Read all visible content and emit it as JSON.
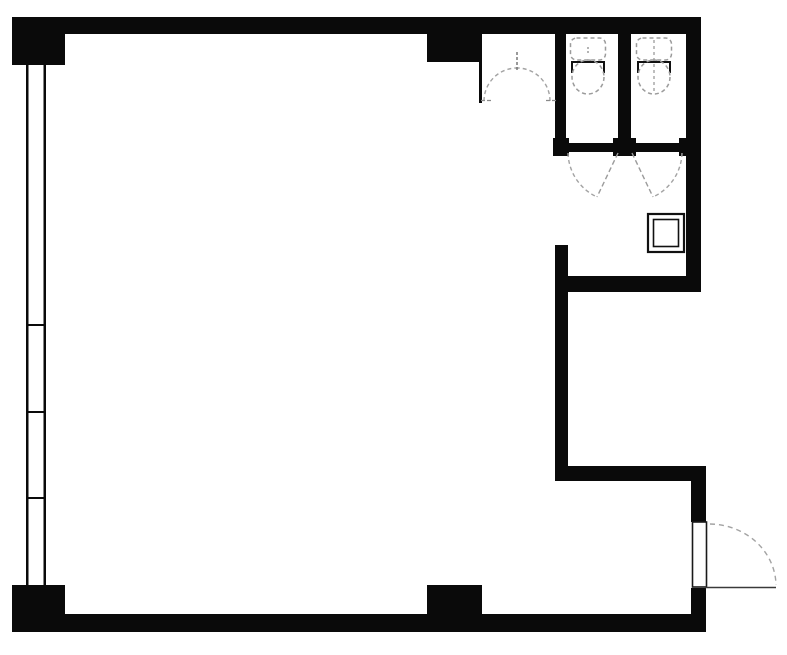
{
  "canvas": {
    "width": 787,
    "height": 655,
    "background": "#ffffff"
  },
  "colors": {
    "wall": "#0a0a0a",
    "thin_line": "#1a1a1a",
    "fixture_dash": "#9b9b9b",
    "door_arc": "#a3a3a3",
    "door_leaf": "#3a3a3a",
    "fixture_solid": "#111111",
    "floor": "#ffffff"
  },
  "floor_plan": {
    "description": "single-room floor plan with two toilet stalls top-right, window wall left, entry door bottom-right",
    "elements": [
      {
        "name": "top-wall",
        "kind": "rect",
        "x": 12,
        "y": 17,
        "w": 688,
        "h": 17
      },
      {
        "name": "top-left-corner-block",
        "kind": "rect",
        "x": 12,
        "y": 17,
        "w": 53,
        "h": 48
      },
      {
        "name": "bottom-left-corner-block",
        "kind": "rect",
        "x": 12,
        "y": 585,
        "w": 53,
        "h": 47
      },
      {
        "name": "bottom-wall",
        "kind": "rect",
        "x": 12,
        "y": 614,
        "w": 692,
        "h": 18
      },
      {
        "name": "top-center-pier",
        "kind": "rect",
        "x": 427,
        "y": 34,
        "w": 53,
        "h": 28
      },
      {
        "name": "bottom-center-pier",
        "kind": "rect",
        "x": 427,
        "y": 585,
        "w": 55,
        "h": 29
      },
      {
        "name": "right-wall-upper",
        "kind": "rect",
        "x": 686,
        "y": 17,
        "w": 15,
        "h": 275
      },
      {
        "name": "stall-left-wall",
        "kind": "rect",
        "x": 555,
        "y": 17,
        "w": 11,
        "h": 126
      },
      {
        "name": "stall-divider-wall",
        "kind": "rect",
        "x": 618,
        "y": 33,
        "w": 13,
        "h": 110
      },
      {
        "name": "stall-front-wall",
        "kind": "rect",
        "x": 555,
        "y": 143,
        "w": 146,
        "h": 9
      },
      {
        "name": "hinge-post-left",
        "kind": "rect",
        "x": 553,
        "y": 138,
        "w": 16,
        "h": 18
      },
      {
        "name": "hinge-post-center",
        "kind": "rect",
        "x": 613,
        "y": 138,
        "w": 23,
        "h": 18
      },
      {
        "name": "hinge-post-right",
        "kind": "rect",
        "x": 679,
        "y": 138,
        "w": 21,
        "h": 18
      },
      {
        "name": "anteroom-south-wall",
        "kind": "rect",
        "x": 555,
        "y": 276,
        "w": 146,
        "h": 16
      },
      {
        "name": "mid-right-wall",
        "kind": "rect",
        "x": 555,
        "y": 245,
        "w": 13,
        "h": 235
      },
      {
        "name": "lower-step-wall",
        "kind": "rect",
        "x": 555,
        "y": 466,
        "w": 151,
        "h": 15
      },
      {
        "name": "entry-wall-upper",
        "kind": "rect",
        "x": 691,
        "y": 466,
        "w": 15,
        "h": 56
      },
      {
        "name": "entry-wall-lower",
        "kind": "rect",
        "x": 691,
        "y": 588,
        "w": 15,
        "h": 44
      },
      {
        "name": "vestibule-partition-wall",
        "kind": "rect",
        "x": 479,
        "y": 34,
        "w": 3,
        "h": 69
      },
      {
        "name": "window-outer-line",
        "kind": "rect",
        "x": 26,
        "y": 65,
        "w": 2.5,
        "h": 520
      },
      {
        "name": "window-inner-line",
        "kind": "rect",
        "x": 43.5,
        "y": 65,
        "w": 2.5,
        "h": 520
      },
      {
        "name": "window-mullion-tick-1",
        "kind": "rect",
        "x": 28,
        "y": 324,
        "w": 16,
        "h": 2
      },
      {
        "name": "window-mullion-tick-2",
        "kind": "rect",
        "x": 28,
        "y": 411,
        "w": 16,
        "h": 2
      },
      {
        "name": "window-mullion-tick-3",
        "kind": "rect",
        "x": 28,
        "y": 497,
        "w": 16,
        "h": 2
      },
      {
        "name": "entrance-door-frame",
        "kind": "orect",
        "x": 692.5,
        "y": 522,
        "w": 14,
        "h": 65,
        "stroke": "#1a1a1a",
        "sw": 1.6,
        "fill": "#ffffff"
      },
      {
        "name": "entrance-door-leaf",
        "kind": "line",
        "x1": 705,
        "y1": 587.5,
        "x2": 776,
        "y2": 587.5,
        "stroke": "#3a3a3a",
        "sw": 1.6
      },
      {
        "name": "entrance-door-swing-arc",
        "kind": "path",
        "d": "M 710,524 A 67,62 0 0 1 776,585",
        "stroke": "#a3a3a3",
        "sw": 1.4,
        "dash": "5,4"
      },
      {
        "name": "vestibule-door-arc-left",
        "kind": "path",
        "d": "M 484,101 A 33,33 0 0 1 517,68",
        "stroke": "#a3a3a3",
        "sw": 1.4,
        "dash": "4,3"
      },
      {
        "name": "vestibule-door-arc-right",
        "kind": "path",
        "d": "M 550,101 A 33,33 0 0 0 517,68",
        "stroke": "#a3a3a3",
        "sw": 1.4,
        "dash": "4,3"
      },
      {
        "name": "vestibule-door-apex-tick",
        "kind": "line",
        "x1": 517,
        "y1": 52,
        "x2": 517,
        "y2": 70,
        "stroke": "#6f6f6f",
        "sw": 1.4,
        "dash": "3,2"
      },
      {
        "name": "vestibule-door-foot-tick-left",
        "kind": "line",
        "x1": 481,
        "y1": 100.5,
        "x2": 492,
        "y2": 100.5,
        "stroke": "#8a8a8a",
        "sw": 1.3,
        "dash": "4,2"
      },
      {
        "name": "vestibule-door-foot-tick-right",
        "kind": "line",
        "x1": 546,
        "y1": 100.5,
        "x2": 557,
        "y2": 100.5,
        "stroke": "#8a8a8a",
        "sw": 1.3,
        "dash": "4,2"
      },
      {
        "name": "stall-door-left-swing-arc",
        "kind": "path",
        "d": "M 568,153 A 50,50 0 0 0 597,197",
        "stroke": "#a3a3a3",
        "sw": 1.4,
        "dash": "4,3"
      },
      {
        "name": "stall-door-left-leaf",
        "kind": "line",
        "x1": 618,
        "y1": 153,
        "x2": 597,
        "y2": 197,
        "stroke": "#9b9b9b",
        "sw": 1.4,
        "dash": "5,3"
      },
      {
        "name": "stall-door-right-swing-arc",
        "kind": "path",
        "d": "M 682,153 A 50,50 0 0 1 653,197",
        "stroke": "#a3a3a3",
        "sw": 1.4,
        "dash": "4,3"
      },
      {
        "name": "stall-door-right-leaf",
        "kind": "line",
        "x1": 632,
        "y1": 153,
        "x2": 653,
        "y2": 197,
        "stroke": "#9b9b9b",
        "sw": 1.4,
        "dash": "5,3"
      },
      {
        "name": "toilet-1-tank",
        "kind": "orect",
        "x": 570.5,
        "y": 38,
        "w": 35,
        "h": 22,
        "rx": 6,
        "stroke": "#9b9b9b",
        "sw": 1.5,
        "fill": "none",
        "dash": "4,3"
      },
      {
        "name": "toilet-1-seat-bar",
        "kind": "path",
        "d": "M 572,73 L 572,62 L 604,62 L 604,73",
        "stroke": "#111111",
        "sw": 2,
        "fill": "none"
      },
      {
        "name": "toilet-1-bowl",
        "kind": "ellipse",
        "cx": 588,
        "cy": 77,
        "rx": 16,
        "ry": 17,
        "stroke": "#9b9b9b",
        "sw": 1.5,
        "dash": "4,3"
      },
      {
        "name": "toilet-1-center-mark",
        "kind": "line",
        "x1": 588,
        "y1": 47,
        "x2": 588,
        "y2": 53,
        "stroke": "#9b9b9b",
        "sw": 1.5,
        "dash": "2,2"
      },
      {
        "name": "toilet-2-tank",
        "kind": "orect",
        "x": 636.5,
        "y": 38,
        "w": 35,
        "h": 22,
        "rx": 6,
        "stroke": "#9b9b9b",
        "sw": 1.5,
        "fill": "none",
        "dash": "4,3"
      },
      {
        "name": "toilet-2-seat-bar",
        "kind": "path",
        "d": "M 638,73 L 638,62 L 670,62 L 670,73",
        "stroke": "#111111",
        "sw": 2,
        "fill": "none"
      },
      {
        "name": "toilet-2-bowl",
        "kind": "ellipse",
        "cx": 654,
        "cy": 77,
        "rx": 16,
        "ry": 17,
        "stroke": "#9b9b9b",
        "sw": 1.5,
        "dash": "4,3"
      },
      {
        "name": "toilet-2-center-line",
        "kind": "line",
        "x1": 654,
        "y1": 40,
        "x2": 654,
        "y2": 92,
        "stroke": "#9b9b9b",
        "sw": 1.3,
        "dash": "3,3"
      },
      {
        "name": "service-shaft-outer-box",
        "kind": "orect",
        "x": 648,
        "y": 214,
        "w": 36,
        "h": 38,
        "stroke": "#111111",
        "sw": 2.2,
        "fill": "#ffffff"
      },
      {
        "name": "service-shaft-inner-box",
        "kind": "orect",
        "x": 653.5,
        "y": 219.5,
        "w": 25,
        "h": 27,
        "stroke": "#111111",
        "sw": 1.6,
        "fill": "none"
      }
    ]
  }
}
